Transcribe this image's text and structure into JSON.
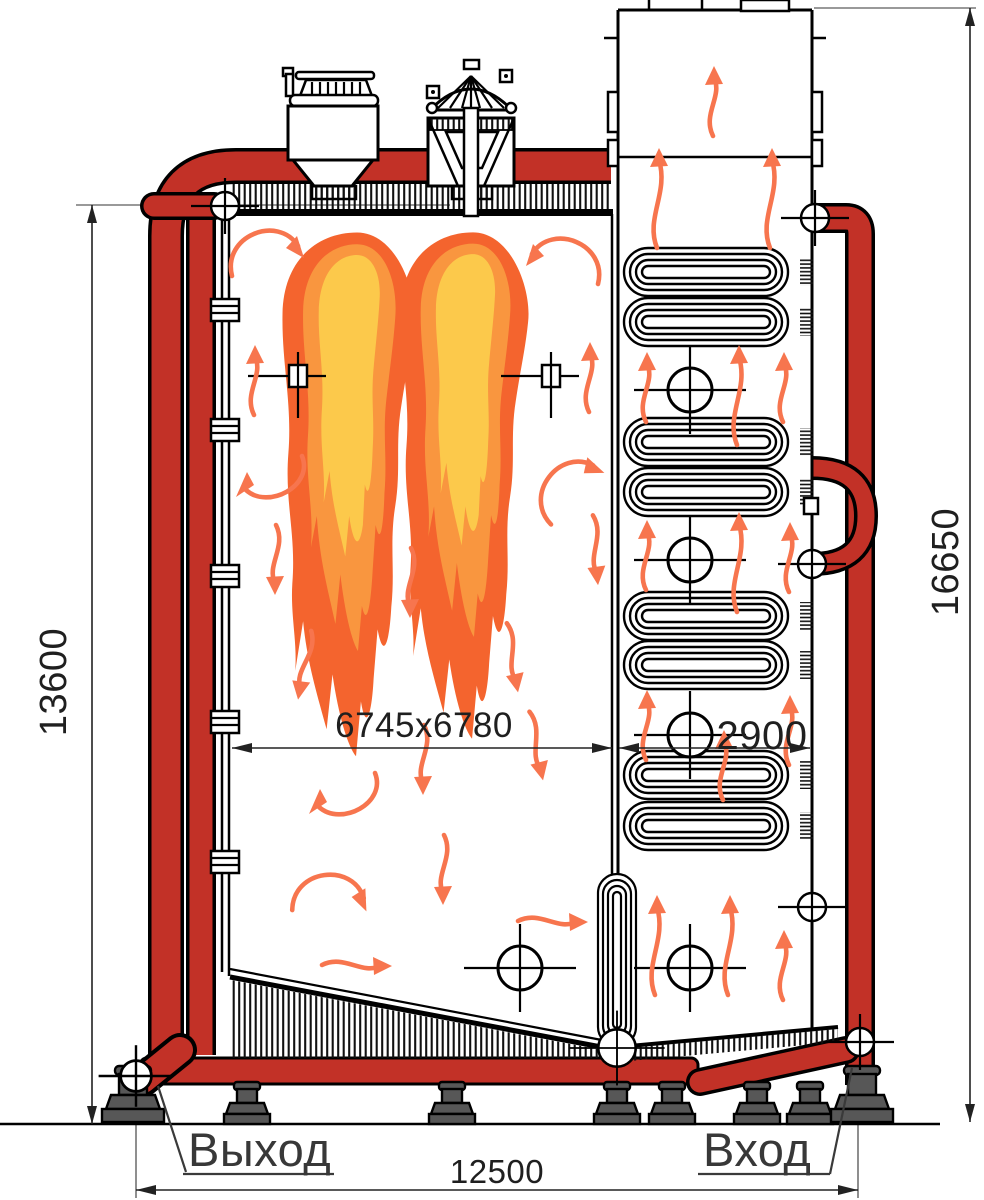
{
  "diagram": {
    "title": "boiler-cutaway-side-view",
    "labels": {
      "outlet": "Выход",
      "inlet": "Вход"
    },
    "dimensions": {
      "overall_height_left": "13600",
      "overall_height_right": "16650",
      "furnace_size": "6745x6780",
      "convective_pass_width": "2900",
      "overall_length": "12500"
    },
    "colors": {
      "pipe_red": "#c23127",
      "flame_outer": "#f4642e",
      "flame_middle": "#f9963f",
      "flame_inner": "#fcc94b",
      "flow_arrow": "#f7754e",
      "support_gray": "#575757",
      "line_black": "#000000"
    },
    "symbols": [
      "flame",
      "flow-arrow",
      "crosshair-center-mark",
      "peephole-mark",
      "serpentine-coil-bank",
      "support-foot",
      "pipe-flange"
    ]
  }
}
